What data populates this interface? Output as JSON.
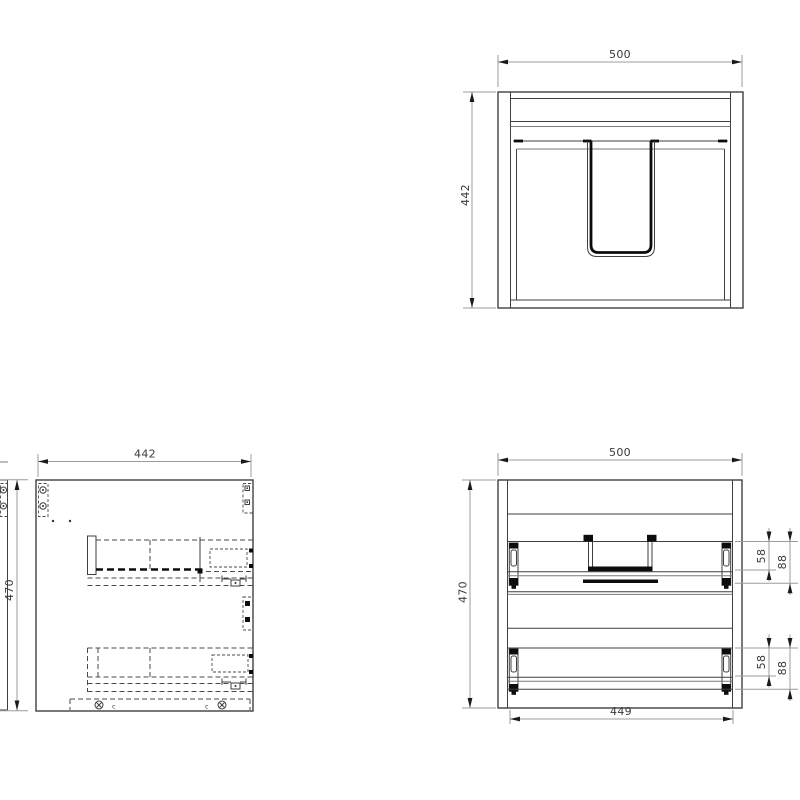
{
  "drawing": {
    "type": "technical-drawing",
    "background": "#ffffff",
    "colors": {
      "object_line": "#3f3f3f",
      "secondary_line": "#7a7a7a",
      "thick_line": "#0c0c0c",
      "dashed_line": "#4a4a4a",
      "dim_line": "#9c9c9c",
      "arrow": "#1a1a1a",
      "dim_text": "#3a3a3a"
    },
    "views": {
      "rear": {
        "dim_width": "500",
        "dim_height": "442"
      },
      "side": {
        "dim_width": "442",
        "dim_height": "470",
        "marker_left": "c",
        "marker_right": "c"
      },
      "front": {
        "dim_width": "500",
        "dim_height": "470",
        "dim_bottom_width": "449",
        "drawer_top": {
          "dim_slide": "58",
          "dim_box": "88"
        },
        "drawer_bottom": {
          "dim_slide": "58",
          "dim_box": "88"
        }
      }
    }
  }
}
